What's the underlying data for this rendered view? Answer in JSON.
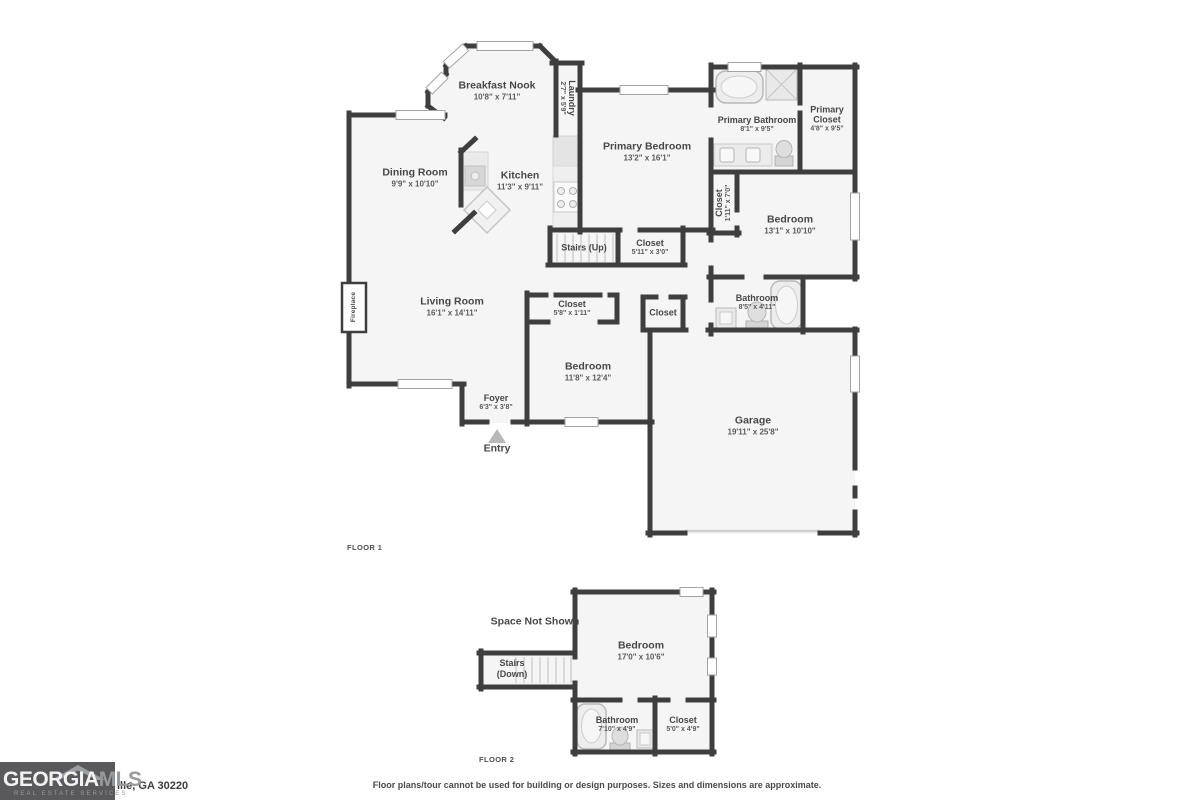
{
  "floor1": {
    "label": "FLOOR 1",
    "rooms": {
      "breakfast_nook": {
        "name": "Breakfast Nook",
        "dims": "10'8\" x 7'11\""
      },
      "laundry": {
        "name": "Laundry",
        "dims": "2'7\" x 5'9\""
      },
      "dining_room": {
        "name": "Dining Room",
        "dims": "9'9\" x 10'10\""
      },
      "kitchen": {
        "name": "Kitchen",
        "dims": "11'3\" x 9'11\""
      },
      "primary_bedroom": {
        "name": "Primary Bedroom",
        "dims": "13'2\" x 16'1\""
      },
      "primary_bathroom": {
        "name": "Primary Bathroom",
        "dims": "8'1\" x 9'5\""
      },
      "primary_closet": {
        "name": "Primary Closet",
        "dims": "4'8\" x 9'5\""
      },
      "closet_hall": {
        "name": "Closet",
        "dims": "1'11\" x 7'0\""
      },
      "bedroom_ne": {
        "name": "Bedroom",
        "dims": "13'1\" x 10'10\""
      },
      "stairs_up": {
        "name": "Stairs (Up)"
      },
      "closet_stairs": {
        "name": "Closet",
        "dims": "5'11\" x 3'0\""
      },
      "bathroom": {
        "name": "Bathroom",
        "dims": "8'5\" x 4'11\""
      },
      "living_room": {
        "name": "Living Room",
        "dims": "16'1\" x 14'11\""
      },
      "fireplace": {
        "name": "Fireplace"
      },
      "closet_bed3": {
        "name": "Closet",
        "dims": "5'8\" x 1'11\""
      },
      "closet_small": {
        "name": "Closet"
      },
      "bedroom_s": {
        "name": "Bedroom",
        "dims": "11'8\" x 12'4\""
      },
      "foyer": {
        "name": "Foyer",
        "dims": "6'3\" x 3'8\""
      },
      "entry": {
        "name": "Entry"
      },
      "garage": {
        "name": "Garage",
        "dims": "19'11\" x 25'8\""
      }
    }
  },
  "floor2": {
    "label": "FLOOR 2",
    "rooms": {
      "space_not_shown": {
        "name": "Space Not Shown"
      },
      "bedroom": {
        "name": "Bedroom",
        "dims": "17'0\" x 10'6\""
      },
      "stairs_down": {
        "name": "Stairs (Down)"
      },
      "bathroom": {
        "name": "Bathroom",
        "dims": "7'10\" x 4'9\""
      },
      "closet": {
        "name": "Closet",
        "dims": "5'0\" x 4'9\""
      }
    }
  },
  "footer": {
    "logo": {
      "brand_primary": "GEORGIA",
      "brand_secondary": "MLS",
      "tagline": "REAL ESTATE SERVICES"
    },
    "address_fragment": "ille, GA 30220",
    "disclaimer": "Floor plans/tour cannot be used for building or design purposes. Sizes and dimensions are approximate."
  },
  "colors": {
    "wall": "#3e3e3e",
    "room_fill": "#f5f5f5",
    "fixture": "#ededed",
    "label": "#474747",
    "logo_bg": "#59595b"
  }
}
